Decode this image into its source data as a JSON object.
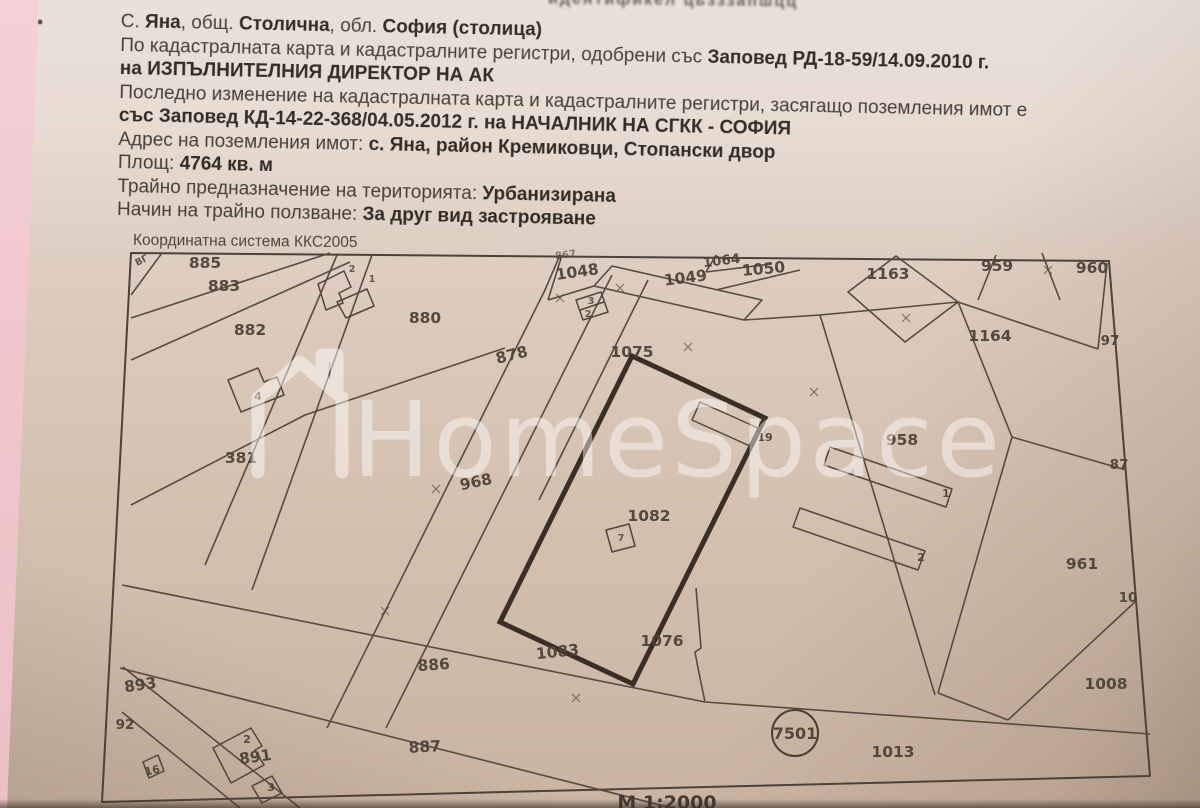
{
  "document": {
    "cropped_top_line": "идентификел   цьзззапшцц",
    "lines": {
      "l1": {
        "s0": "С. ",
        "b0": "Яна",
        "s1": ", общ. ",
        "b1": "Столична",
        "s2": ", обл. ",
        "b2": "София (столица)"
      },
      "l2": {
        "s0": "По кадастралната карта и кадастралните регистри, одобрени със ",
        "b0": "Заповед РД-18-59/14.09.2010 г."
      },
      "l3": {
        "b0": "на ИЗПЪЛНИТЕЛНИЯ ДИРЕКТОР НА АК"
      },
      "l4": {
        "s0": "Последно изменение на кадастралната карта и кадастралните регистри, засягащо поземления имот е"
      },
      "l5": {
        "b0": "със Заповед КД-14-22-368/04.05.2012 г. на НАЧАЛНИК НА СГКК - СОФИЯ"
      },
      "l6": {
        "s0": "Адрес на поземления имот: ",
        "b0": "с. Яна, район Кремиковци, Стопански двор"
      },
      "l7": {
        "s0": "Площ: ",
        "b0": "4764 кв. м"
      },
      "l8": {
        "s0": "Трайно предназначение на територията: ",
        "b0": "Урбанизирана"
      },
      "l9": {
        "s0": "Начин на трайно ползване: ",
        "b0": "За друг вид застрояване"
      }
    },
    "coordinate_system": "Координатна система ККС2005",
    "scale": "М 1:2000"
  },
  "map": {
    "watermark": "HomeSpace",
    "labels": {
      "p885": "885",
      "p883": "883",
      "p882": "882",
      "p880": "880",
      "p878": "878",
      "p381": "381",
      "p968": "968",
      "p1048": "1048",
      "p1048_partial": "867",
      "p1049": "1049",
      "p1064": "1064",
      "p1050": "1050",
      "p1163": "1163",
      "p959": "959",
      "p960": "960",
      "p1164": "1164",
      "p97": "97",
      "p1075": "1075",
      "p1082": "1082",
      "p958": "958",
      "p961": "961",
      "p87": "87",
      "p10": "10",
      "p1008": "1008",
      "p1083": "1083",
      "p1076": "1076",
      "p886": "886",
      "p887": "887",
      "p893": "893",
      "p92": "92",
      "p891": "891",
      "p1013": "1013",
      "p7501": "7501",
      "b4": "4",
      "b19": "19",
      "b7": "7",
      "b1": "1",
      "b2": "2",
      "b3": "3",
      "b2s": "2",
      "b1s": "1",
      "b2t": "2",
      "b16": "16",
      "b2w": "2",
      "b3w": "3",
      "corner": "ВГ"
    }
  }
}
